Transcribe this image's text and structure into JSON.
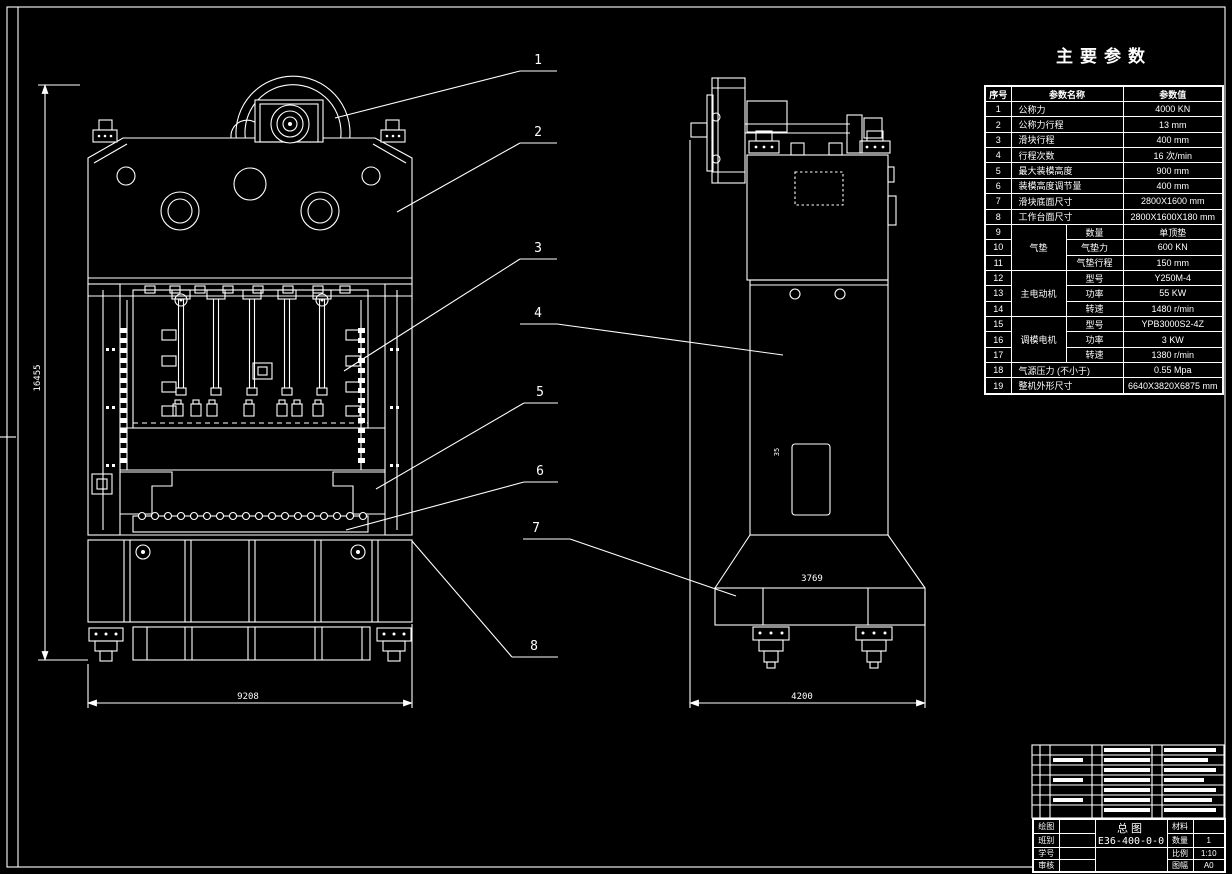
{
  "params_table": {
    "title": "主要参数",
    "col_no": "序号",
    "col_name": "参数名称",
    "col_value": "参数值",
    "rows": [
      {
        "no": "1",
        "name": "公称力",
        "value": "4000 KN"
      },
      {
        "no": "2",
        "name": "公称力行程",
        "value": "13 mm"
      },
      {
        "no": "3",
        "name": "滑块行程",
        "value": "400 mm"
      },
      {
        "no": "4",
        "name": "行程次数",
        "value": "16 次/min"
      },
      {
        "no": "5",
        "name": "最大装模高度",
        "value": "900 mm"
      },
      {
        "no": "6",
        "name": "装模高度调节量",
        "value": "400 mm"
      },
      {
        "no": "7",
        "name": "滑块底面尺寸",
        "value": "2800X1600 mm"
      },
      {
        "no": "8",
        "name": "工作台面尺寸",
        "value": "2800X1600X180 mm"
      },
      {
        "no": "9",
        "group": "气垫",
        "sub": "数量",
        "value": "单顶垫"
      },
      {
        "no": "10",
        "sub": "气垫力",
        "value": "600 KN"
      },
      {
        "no": "11",
        "sub": "气垫行程",
        "value": "150 mm"
      },
      {
        "no": "12",
        "group": "主电动机",
        "sub": "型号",
        "value": "Y250M-4"
      },
      {
        "no": "13",
        "sub": "功率",
        "value": "55 KW"
      },
      {
        "no": "14",
        "sub": "转速",
        "value": "1480 r/min"
      },
      {
        "no": "15",
        "group": "调模电机",
        "sub": "型号",
        "value": "YPB3000S2-4Z"
      },
      {
        "no": "16",
        "sub": "功率",
        "value": "3 KW"
      },
      {
        "no": "17",
        "sub": "转速",
        "value": "1380 r/min"
      },
      {
        "no": "18",
        "name": "气源压力 (不小于)",
        "value": "0.55 Mpa"
      },
      {
        "no": "19",
        "name": "整机外形尺寸",
        "value": "6640X3820X6875 mm"
      }
    ]
  },
  "callouts": [
    "1",
    "2",
    "3",
    "4",
    "5",
    "6",
    "7",
    "8"
  ],
  "dimensions": {
    "front_height": "16455",
    "front_width": "9208",
    "side_width": "4200",
    "side_flange": "3769",
    "side_note": "35"
  },
  "title_block": {
    "drawing_name": "总图",
    "drawing_no": "E36-400-0-0",
    "left_rows": [
      {
        "label": "绘图",
        "value": ""
      },
      {
        "label": "班别",
        "value": ""
      },
      {
        "label": "学号",
        "value": ""
      },
      {
        "label": "审核",
        "value": ""
      }
    ],
    "right_rows": [
      {
        "label": "材料",
        "value": ""
      },
      {
        "label": "数量",
        "value": "1"
      },
      {
        "label": "比例",
        "value": "1:10"
      },
      {
        "label": "图幅",
        "value": "A0"
      }
    ]
  }
}
